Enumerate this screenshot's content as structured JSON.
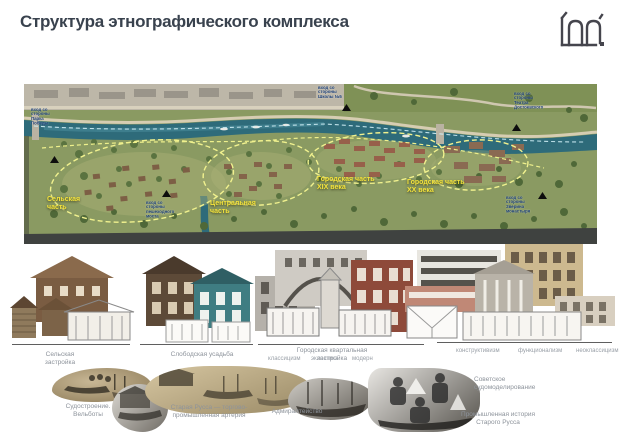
{
  "title": "Структура этнографического комплекса",
  "icons": {
    "logo": "studio-monogram",
    "map_marker": "entrance-arrow"
  },
  "colors": {
    "title_text": "#39424e",
    "zone_label_yellow": "#f4e33b",
    "entrance_label_blue": "#1c3f77",
    "river_teal": "#2e6b7a",
    "caption_gray": "#8d939b"
  },
  "map": {
    "zones": [
      {
        "label": "Сельская часть"
      },
      {
        "label": "Центральная часть"
      },
      {
        "label": "Городская часть XIX века"
      },
      {
        "label": "Городская часть XX века"
      }
    ],
    "entrances": [
      {
        "label": "вход со стороны Парка Победы"
      },
      {
        "label": "вход со стороны Школы №5"
      },
      {
        "label": "вход со стороны Театра Достоевского"
      },
      {
        "label": "вход со стороны пешеходного моста"
      },
      {
        "label": "вход со стороны Зверина монастыря"
      }
    ]
  },
  "architecture": {
    "groups": [
      {
        "caption": "Сельская застройка"
      },
      {
        "caption": "Слободская усадьба"
      },
      {
        "caption": "Городская квартальная застройка",
        "styles": [
          "классицизм",
          "эклектика",
          "модерн"
        ]
      },
      {
        "caption": "",
        "styles": [
          "конструктивизм",
          "функционализм",
          "неоклассицизм"
        ]
      }
    ]
  },
  "history": {
    "items": [
      {
        "caption": "Судостроение. Вельботы"
      },
      {
        "caption": "Старая Русса — торгово-промышленная артерия"
      },
      {
        "caption": "Адмиралтейство"
      },
      {
        "caption": "Советское судомоделирование"
      },
      {
        "caption": "Промышленная история Старого Русса"
      }
    ]
  }
}
